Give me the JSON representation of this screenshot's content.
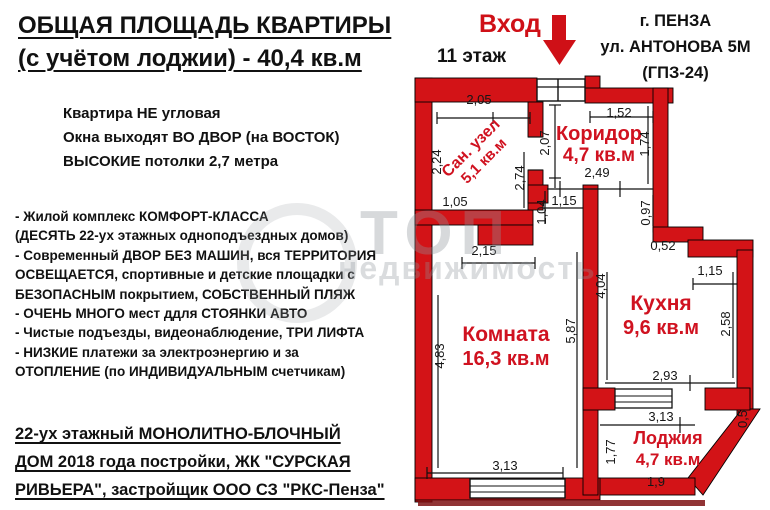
{
  "header": {
    "title_line1": "ОБЩАЯ ПЛОЩАДЬ КВАРТИРЫ",
    "title_line2": "(с учётом лоджии) - 40,4 кв.м",
    "entrance_label": "Вход",
    "floor_label": "11 этаж",
    "address": {
      "city": "г. ПЕНЗА",
      "street": "ул. АНТОНОВА 5М",
      "district": "(ГПЗ-24)"
    }
  },
  "highlights": [
    "Квартира НЕ угловая",
    "Окна выходят ВО ДВОР (на ВОСТОК)",
    "ВЫСОКИЕ потолки 2,7 метра"
  ],
  "features": [
    "- Жилой комплекс КОМФОРТ-КЛАССА",
    "(ДЕСЯТЬ 22-ух этажных одноподъездных домов)",
    "- Современный ДВОР БЕЗ МАШИН, вся ТЕРРИТОРИЯ",
    "ОСВЕЩАЕТСЯ, спортивные и детские площадки с",
    "БЕЗОПАСНЫМ покрытием, СОБСТВЕННЫЙ ПЛЯЖ",
    "- ОЧЕНЬ МНОГО мест ддля СТОЯНКИ АВТО",
    "- Чистые подъезды, видеонаблюдение, ТРИ ЛИФТА",
    "- НИЗКИЕ платежи за электроэнергию и за",
    "ОТОПЛЕНИЕ (по ИНДИВИДУАЛЬНЫМ счетчикам)"
  ],
  "building_info": [
    "22-ух этажный МОНОЛИТНО-БЛОЧНЫЙ",
    "ДОМ 2018 года постройки, ЖК \"СУРСКАЯ",
    "РИВЬЕРА\", застройщик ООО СЗ \"РКС-Пенза\""
  ],
  "watermark": {
    "word1": "ТОП",
    "word2": "недвижимость"
  },
  "plan": {
    "rooms": {
      "sanuzel": {
        "name": "Сан. узел",
        "area": "5,1 кв.м"
      },
      "koridor": {
        "name": "Коридор",
        "area": "4,7 кв.м"
      },
      "komnata": {
        "name": "Комната",
        "area": "16,3 кв.м"
      },
      "kuhnya": {
        "name": "Кухня",
        "area": "9,6 кв.м"
      },
      "lodzhiya": {
        "name": "Лоджия",
        "area": "4,7 кв.м"
      }
    },
    "dims": {
      "sanuzel_top": "2,05",
      "sanuzel_left": "2,24",
      "sanuzel_bottom": "1,05",
      "sanuzel_right": "2,74",
      "koridor_top": "1,52",
      "koridor_left": "2,07",
      "koridor_right": "1,74",
      "koridor_bottom": "2,49",
      "hall_width": "1,15",
      "hall_left": "1,04",
      "hall_right": "0,97",
      "komnata_top": "2,15",
      "komnata_left": "4,83",
      "komnata_right": "5,87",
      "komnata_bottom": "3,13",
      "kuhnya_left": "4,04",
      "kuhnya_step": "0,52",
      "kuhnya_top": "1,15",
      "kuhnya_right": "2,58",
      "kuhnya_bottom": "2,93",
      "lodzhiya_top": "3,13",
      "lodzhiya_left": "1,77",
      "lodzhiya_bottom": "1,9",
      "lodzhiya_right": "0,5"
    }
  },
  "colors": {
    "wall_red": "#d31317",
    "label_red": "#d01220",
    "text_black": "#161616"
  }
}
